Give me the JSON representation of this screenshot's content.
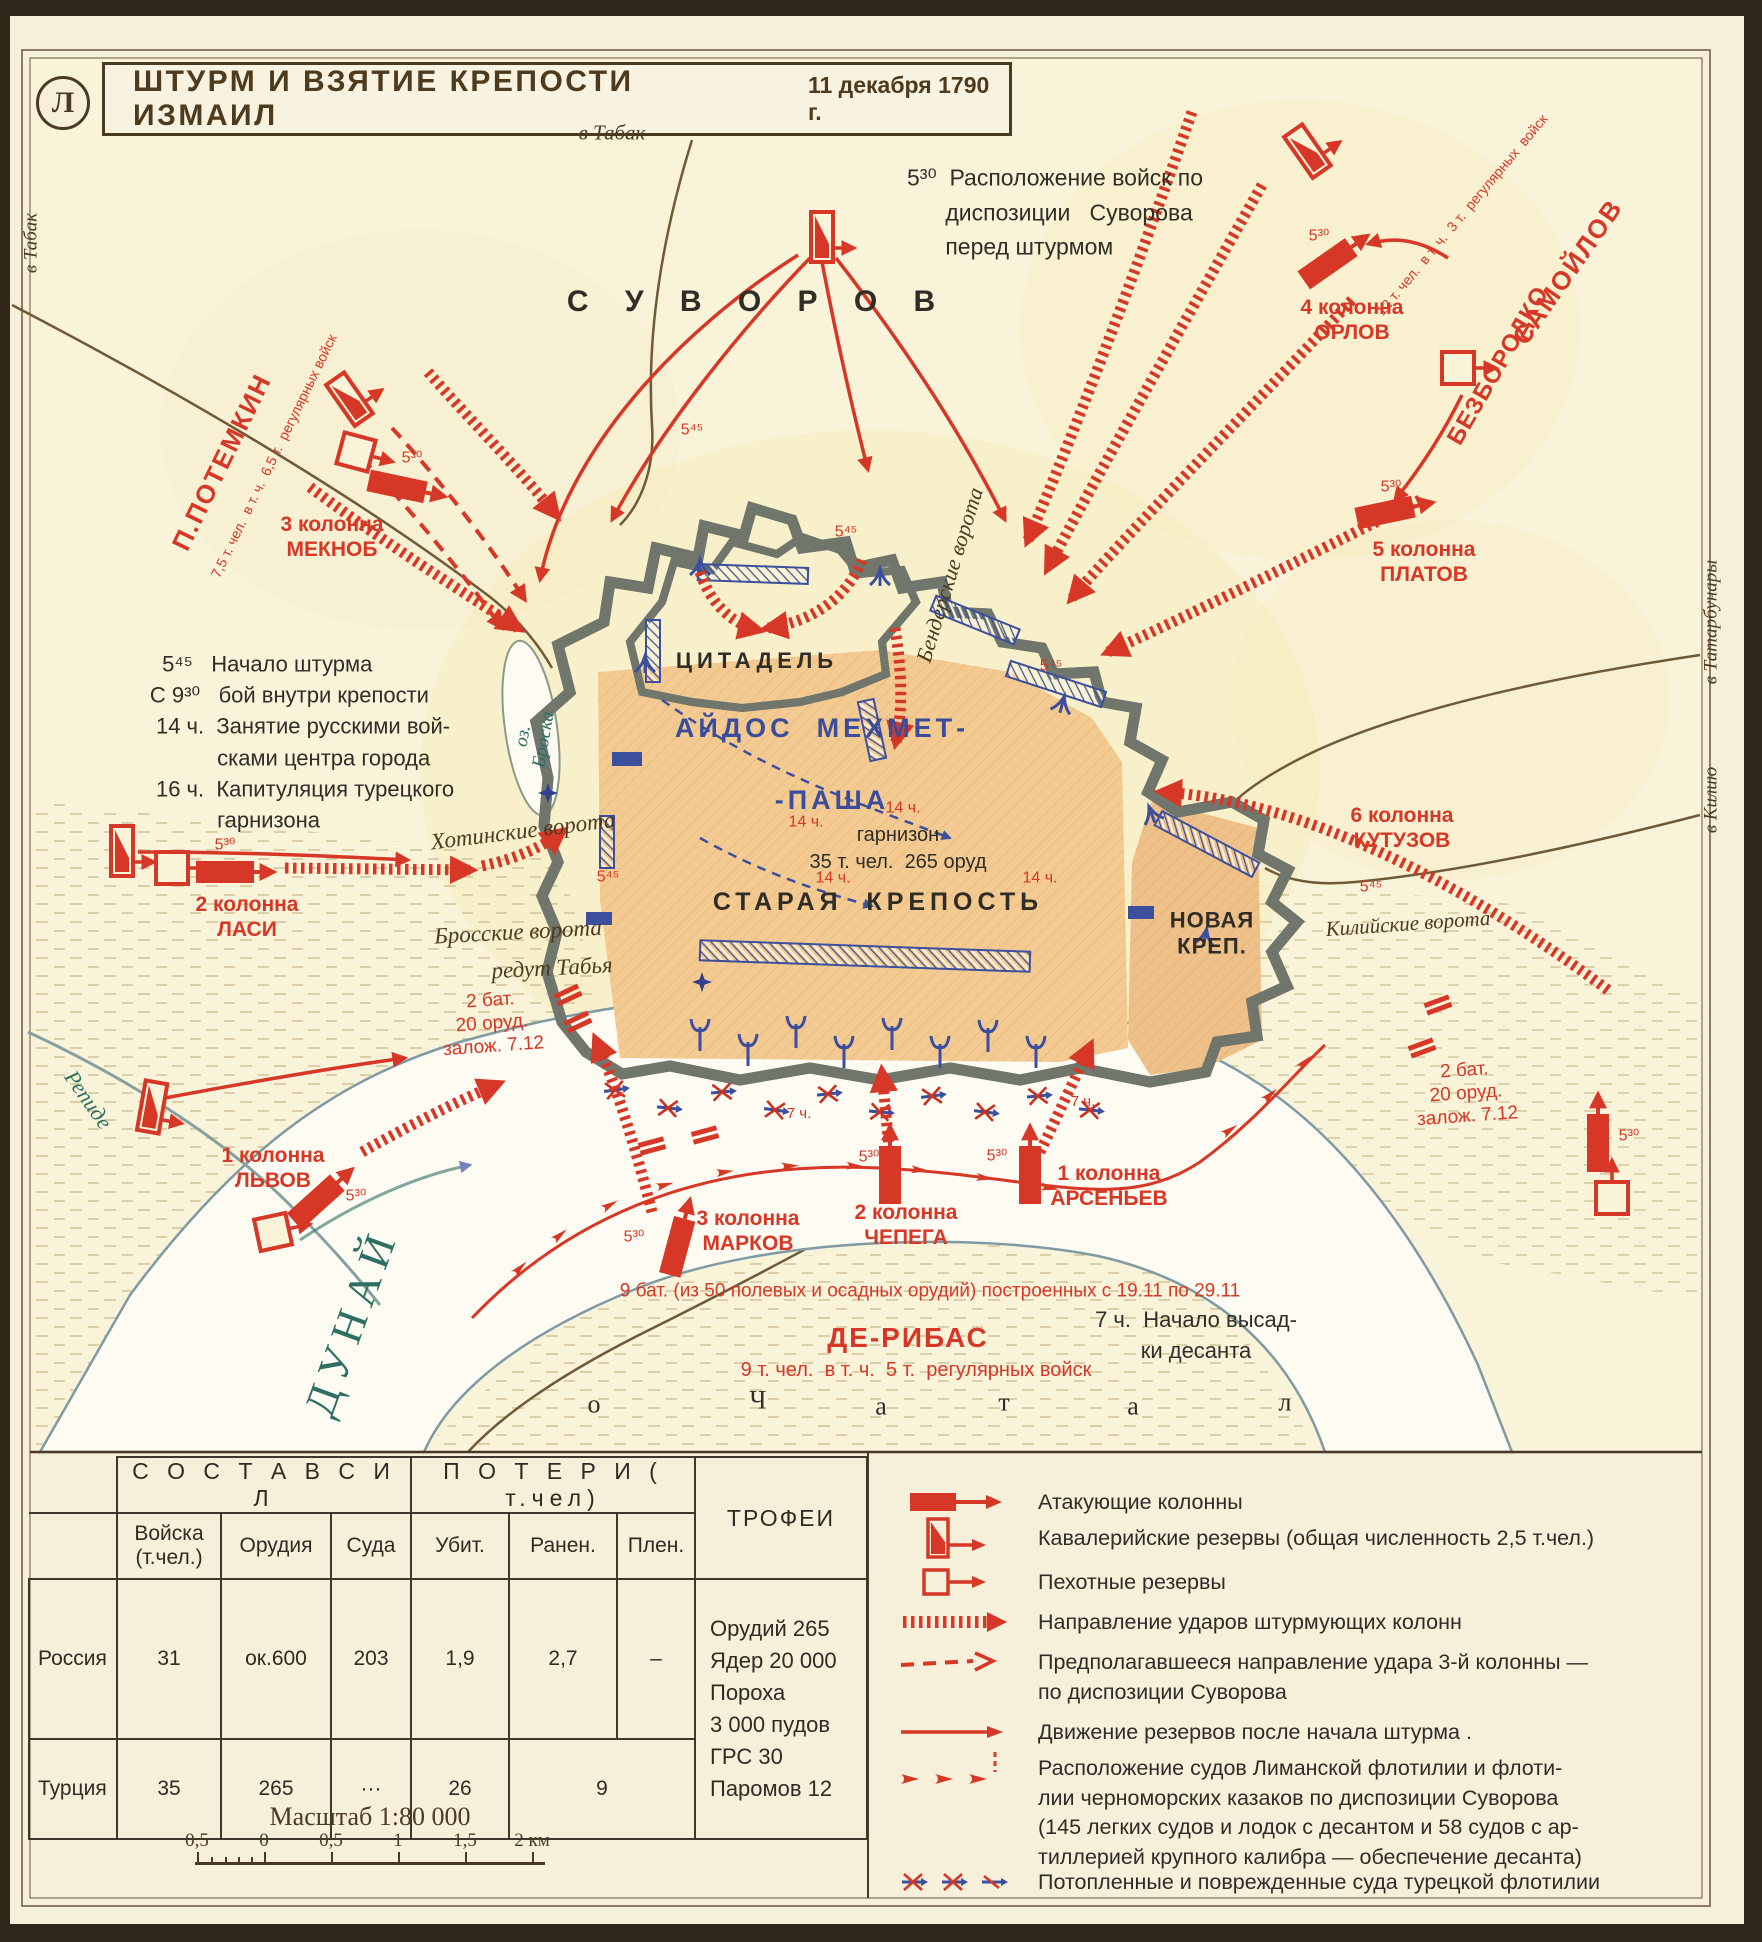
{
  "frame": {
    "plate_letter": "Л"
  },
  "title": {
    "text": "ШТУРМ И ВЗЯТИЕ КРЕПОСТИ ИЗМАИЛ",
    "date": "11 декабря 1790 г."
  },
  "colors": {
    "accent_red": "#d63726",
    "navy_blue": "#3a4d9c",
    "teal_water": "#2f6f63",
    "ink": "#2f2d26",
    "brown": "#4a3a22",
    "fortress_tan": "#f3cb92"
  },
  "map": {
    "labels": [
      {
        "n": "commander-suvorov-label",
        "t": "С У В О Р О В",
        "x": 758,
        "y": 302,
        "s": 30,
        "c": "k",
        "ls": 14,
        "b": 1
      },
      {
        "n": "road-label-tabak-top",
        "t": "в Табак",
        "x": 612,
        "y": 133,
        "s": 21,
        "c": "n",
        "i": 1,
        "f": "serif"
      },
      {
        "n": "road-label-tabak-left",
        "t": "в Табак",
        "x": 32,
        "y": 243,
        "s": 19,
        "c": "n",
        "i": 1,
        "f": "serif",
        "r": -90
      },
      {
        "n": "disposition-note",
        "t": "5³⁰  Расположение войск по\n      диспозиции   Суворова\n      перед штурмом",
        "x": 1055,
        "y": 212,
        "s": 23,
        "c": "k",
        "a": "left",
        "lh": 1.5
      },
      {
        "n": "timeline-note",
        "t": "  5⁴⁵   Начало штурма\nС 9³⁰   бой внутри крепости\n 14 ч.  Занятие русскими вой-\n           сками центра города\n 16 ч.  Капитуляция турецкого\n           гарнизона",
        "x": 302,
        "y": 742,
        "s": 22,
        "c": "k",
        "a": "left",
        "lh": 1.42
      },
      {
        "n": "commander-potemkin-label",
        "t": "П.ПОТЕМКИН",
        "x": 222,
        "y": 462,
        "s": 26,
        "c": "r",
        "r": -64,
        "b": 1,
        "ls": 2
      },
      {
        "n": "potemkin-strength-note",
        "t": "7,5 т. чел.  в т. ч.  6,5 т.  регулярных войск",
        "x": 274,
        "y": 456,
        "s": 14,
        "c": "r",
        "r": -64
      },
      {
        "n": "column-3-meknob-label",
        "t": "3 колонна\nМЕКНОБ",
        "x": 332,
        "y": 537,
        "s": 21,
        "c": "r",
        "b": 1
      },
      {
        "n": "column-2-lasi-label",
        "t": "2 колонна\nЛАСИ",
        "x": 247,
        "y": 917,
        "s": 21,
        "c": "r",
        "b": 1
      },
      {
        "n": "column-1-lvov-label",
        "t": "1 колонна\nЛЬВОВ",
        "x": 273,
        "y": 1168,
        "s": 21,
        "c": "r",
        "b": 1
      },
      {
        "n": "column-4-orlov-label",
        "t": "4 колонна\nОРЛОВ",
        "x": 1352,
        "y": 320,
        "s": 21,
        "c": "r",
        "b": 1
      },
      {
        "n": "commander-samoylov-label",
        "t": "САМОЙЛОВ",
        "x": 1568,
        "y": 272,
        "s": 26,
        "c": "r",
        "r": -55,
        "b": 1,
        "ls": 2
      },
      {
        "n": "commander-bezborodko-label",
        "t": "БЕЗБОРОДКО",
        "x": 1499,
        "y": 366,
        "s": 24,
        "c": "r",
        "r": -60,
        "b": 1,
        "ls": 1
      },
      {
        "n": "samoylov-strength-note",
        "t": "12 т. чел.  в т. ч.  3 т.  регулярных  войск",
        "x": 1462,
        "y": 215,
        "s": 14,
        "c": "r",
        "r": -50
      },
      {
        "n": "column-5-platov-label",
        "t": "5 колонна\nПЛАТОВ",
        "x": 1424,
        "y": 562,
        "s": 21,
        "c": "r",
        "b": 1
      },
      {
        "n": "column-6-kutuzov-label",
        "t": "6 колонна\nКУТУЗОВ",
        "x": 1402,
        "y": 828,
        "s": 21,
        "c": "r",
        "b": 1
      },
      {
        "n": "novaya-krepost-label",
        "t": "НОВАЯ\nКРЕП.",
        "x": 1212,
        "y": 934,
        "s": 22,
        "c": "k",
        "b": 1,
        "ls": 1
      },
      {
        "n": "kiliyskie-vorota-label",
        "t": "Килийские ворота",
        "x": 1408,
        "y": 924,
        "s": 21,
        "c": "n",
        "i": 1,
        "f": "serif",
        "r": -4
      },
      {
        "n": "tsitadel-label",
        "t": "ЦИТАДЕЛЬ",
        "x": 757,
        "y": 661,
        "s": 22,
        "c": "k",
        "b": 1,
        "ls": 5
      },
      {
        "n": "aydos-mehmet-label",
        "t": "АЙДОС  МЕХМЕТ-",
        "x": 822,
        "y": 728,
        "s": 27,
        "c": "b",
        "b": 1,
        "ls": 4
      },
      {
        "n": "pasha-label",
        "t": "-ПАША",
        "x": 832,
        "y": 800,
        "s": 27,
        "c": "b",
        "b": 1,
        "ls": 4
      },
      {
        "n": "garrison-note",
        "t": "гарнизон\n35 т. чел.  265 оруд",
        "x": 898,
        "y": 849,
        "s": 20,
        "c": "k",
        "lh": 1.35
      },
      {
        "n": "staraya-krepost-label",
        "t": "СТАРАЯ  КРЕПОСТЬ",
        "x": 878,
        "y": 902,
        "s": 25,
        "c": "k",
        "b": 1,
        "ls": 5
      },
      {
        "n": "benderskie-vorota-label",
        "t": "Бендерские ворота",
        "x": 950,
        "y": 575,
        "s": 22,
        "c": "n",
        "i": 1,
        "f": "serif",
        "r": -73
      },
      {
        "n": "khotinskie-vorota-label",
        "t": "Хотинские ворота",
        "x": 523,
        "y": 831,
        "s": 23,
        "c": "n",
        "i": 1,
        "f": "serif",
        "r": -7
      },
      {
        "n": "brosskie-vorota-label",
        "t": "Бросские ворота",
        "x": 518,
        "y": 932,
        "s": 23,
        "c": "n",
        "i": 1,
        "f": "serif",
        "r": -3
      },
      {
        "n": "redut-tabya-label",
        "t": "редут Табья",
        "x": 552,
        "y": 968,
        "s": 23,
        "c": "n",
        "i": 1,
        "f": "serif",
        "r": -3
      },
      {
        "n": "lake-broska-label",
        "t": "оз.\nБроска",
        "x": 534,
        "y": 738,
        "s": 19,
        "c": "t",
        "i": 1,
        "f": "serif",
        "r": -80,
        "lh": 1.1
      },
      {
        "n": "dunay-river-label",
        "t": "ДУНАЙ",
        "x": 352,
        "y": 1322,
        "s": 44,
        "c": "t",
        "f": "serif",
        "r": -70,
        "ls": 8
      },
      {
        "n": "repide-river-label",
        "t": "Репиде",
        "x": 88,
        "y": 1100,
        "s": 22,
        "c": "t",
        "i": 1,
        "f": "serif",
        "r": 55
      },
      {
        "n": "road-label-tatarbunary",
        "t": "в Татарбунары",
        "x": 1712,
        "y": 622,
        "s": 19,
        "c": "n",
        "i": 1,
        "f": "serif",
        "r": -90
      },
      {
        "n": "road-label-kiliyu",
        "t": "в Килию",
        "x": 1712,
        "y": 800,
        "s": 19,
        "c": "n",
        "i": 1,
        "f": "serif",
        "r": -90
      },
      {
        "n": "column-3-markov-label",
        "t": "3 колонна\nМАРКОВ",
        "x": 748,
        "y": 1231,
        "s": 21,
        "c": "r",
        "b": 1
      },
      {
        "n": "column-2-chepega-label",
        "t": "2 колонна\nЧЕПЕГА",
        "x": 906,
        "y": 1225,
        "s": 21,
        "c": "r",
        "b": 1
      },
      {
        "n": "column-1-arsenev-label",
        "t": "1 колонна\nАРСЕНЬЕВ",
        "x": 1109,
        "y": 1186,
        "s": 21,
        "c": "r",
        "b": 1
      },
      {
        "n": "batteries-9-note",
        "t": "9 бат. (из 50 полевых и осадных орудий) построенных с 19.11 по 29.11",
        "x": 930,
        "y": 1292,
        "s": 19,
        "c": "r"
      },
      {
        "n": "commander-deribas-label",
        "t": "ДЕ-РИБАС",
        "x": 908,
        "y": 1338,
        "s": 28,
        "c": "r",
        "b": 1,
        "ls": 2
      },
      {
        "n": "deribas-strength-note",
        "t": "9 т. чел.  в т. ч.  5 т.  регулярных войск",
        "x": 916,
        "y": 1370,
        "s": 20,
        "c": "r"
      },
      {
        "n": "landing-note",
        "t": "7 ч.  Начало высад-\nки десанта",
        "x": 1196,
        "y": 1336,
        "s": 22,
        "c": "k",
        "lh": 1.4
      },
      {
        "n": "chatal-letter",
        "t": "о",
        "x": 594,
        "y": 1404,
        "s": 26,
        "c": "k",
        "f": "serif"
      },
      {
        "n": "chatal-letter",
        "t": "Ч",
        "x": 758,
        "y": 1400,
        "s": 26,
        "c": "k",
        "f": "serif"
      },
      {
        "n": "chatal-letter",
        "t": "а",
        "x": 881,
        "y": 1406,
        "s": 26,
        "c": "k",
        "f": "serif"
      },
      {
        "n": "chatal-letter",
        "t": "т",
        "x": 1004,
        "y": 1402,
        "s": 26,
        "c": "k",
        "f": "serif"
      },
      {
        "n": "chatal-letter",
        "t": "а",
        "x": 1133,
        "y": 1406,
        "s": 26,
        "c": "k",
        "f": "serif"
      },
      {
        "n": "chatal-letter",
        "t": "л",
        "x": 1285,
        "y": 1402,
        "s": 26,
        "c": "k",
        "f": "serif"
      },
      {
        "n": "battery-note-left",
        "t": "2 бат.\n20 оруд.\nзалож. 7.12",
        "x": 492,
        "y": 1024,
        "s": 19,
        "c": "r",
        "r": -4
      },
      {
        "n": "battery-note-right",
        "t": "2 бат.\n20 оруд.\nзалож. 7.12",
        "x": 1466,
        "y": 1094,
        "s": 19,
        "c": "r",
        "r": -4
      },
      {
        "n": "time-marker",
        "t": "5⁴⁵",
        "x": 846,
        "y": 532,
        "s": 16,
        "c": "r"
      },
      {
        "n": "time-marker",
        "t": "5⁴⁵",
        "x": 608,
        "y": 877,
        "s": 16,
        "c": "r"
      },
      {
        "n": "time-marker",
        "t": "5⁴⁵",
        "x": 1051,
        "y": 666,
        "s": 16,
        "c": "r"
      },
      {
        "n": "time-marker",
        "t": "5⁴⁵",
        "x": 1371,
        "y": 887,
        "s": 16,
        "c": "r"
      },
      {
        "n": "time-marker",
        "t": "5⁴⁵",
        "x": 692,
        "y": 430,
        "s": 16,
        "c": "r"
      },
      {
        "n": "time-marker",
        "t": "5³⁰",
        "x": 412,
        "y": 458,
        "s": 16,
        "c": "r"
      },
      {
        "n": "time-marker",
        "t": "5³⁰",
        "x": 225,
        "y": 845,
        "s": 16,
        "c": "r"
      },
      {
        "n": "time-marker",
        "t": "5³⁰",
        "x": 356,
        "y": 1196,
        "s": 16,
        "c": "r"
      },
      {
        "n": "time-marker",
        "t": "5³⁰",
        "x": 634,
        "y": 1237,
        "s": 16,
        "c": "r"
      },
      {
        "n": "time-marker",
        "t": "5³⁰",
        "x": 869,
        "y": 1157,
        "s": 16,
        "c": "r"
      },
      {
        "n": "time-marker",
        "t": "5³⁰",
        "x": 997,
        "y": 1156,
        "s": 16,
        "c": "r"
      },
      {
        "n": "time-marker",
        "t": "5³⁰",
        "x": 1629,
        "y": 1136,
        "s": 16,
        "c": "r"
      },
      {
        "n": "time-marker",
        "t": "5³⁰",
        "x": 1319,
        "y": 236,
        "s": 16,
        "c": "r"
      },
      {
        "n": "time-marker",
        "t": "5³⁰",
        "x": 1391,
        "y": 487,
        "s": 16,
        "c": "r"
      },
      {
        "n": "time-marker",
        "t": "14 ч.",
        "x": 806,
        "y": 822,
        "s": 16,
        "c": "r"
      },
      {
        "n": "time-marker",
        "t": "14 ч.",
        "x": 903,
        "y": 808,
        "s": 16,
        "c": "r"
      },
      {
        "n": "time-marker",
        "t": "14 ч.",
        "x": 833,
        "y": 878,
        "s": 16,
        "c": "r"
      },
      {
        "n": "time-marker",
        "t": "14 ч.",
        "x": 1040,
        "y": 878,
        "s": 16,
        "c": "r"
      },
      {
        "n": "time-marker",
        "t": "7 ч.",
        "x": 799,
        "y": 1114,
        "s": 15,
        "c": "r"
      },
      {
        "n": "time-marker",
        "t": "7 ч.",
        "x": 1083,
        "y": 1102,
        "s": 15,
        "c": "r"
      }
    ]
  },
  "table": {
    "composition_header": "С О С Т А В   С И Л",
    "losses_header": "П О Т Е Р И   ( т.чел)",
    "trophies_header": "ТРОФЕИ",
    "col_headers": [
      "Войска (т.чел.)",
      "Орудия",
      "Суда",
      "Убит.",
      "Ранен.",
      "Плен."
    ],
    "rows": [
      {
        "name": "Россия",
        "troops": "31",
        "guns": "ок.600",
        "ships": "203",
        "killed": "1,9",
        "wounded": "2,7",
        "captured": "–"
      },
      {
        "name": "Турция",
        "troops": "35",
        "guns": "265",
        "ships": "···",
        "killed": "26",
        "wounded_captured": "9"
      }
    ],
    "trophies_lines": [
      "Орудий 265",
      "Ядер 20 000",
      "Пороха",
      "3 000 пудов",
      "ГРС 30",
      "Паромов 12"
    ],
    "scale": {
      "label": "Масштаб 1:80 000",
      "ticks": [
        "0,5",
        "0",
        "0,5",
        "1",
        "1,5",
        "2 км"
      ]
    }
  },
  "legend": {
    "items": [
      {
        "symbol": "attack-column-symbol",
        "text": "Атакующие колонны"
      },
      {
        "symbol": "cavalry-reserve-symbol",
        "text": "Кавалерийские резервы (общая численность 2,5 т.чел.)"
      },
      {
        "symbol": "infantry-reserve-symbol",
        "text": "Пехотные резервы"
      },
      {
        "symbol": "strike-direction-symbol",
        "text": "Направление  ударов штурмующих колонн"
      },
      {
        "symbol": "planned-direction-symbol",
        "text": "Предполагавшееся направление удара 3-й колонны —\nпо диспозиции Суворова"
      },
      {
        "symbol": "reserve-movement-symbol",
        "text": "Движение резервов после начала штурма ."
      },
      {
        "symbol": "flotilla-symbol",
        "text": "Расположение судов Лиманской флотилии и флоти-\nлии черноморских казаков по диспозиции Суворова\n(145 легких судов и лодок с десантом и 58 судов с ар-\nтиллерией крупного калибра — обеспечение десанта)"
      },
      {
        "symbol": "sunken-ships-symbol",
        "text": "Потопленные и поврежденные суда турецкой флотилии"
      }
    ]
  }
}
